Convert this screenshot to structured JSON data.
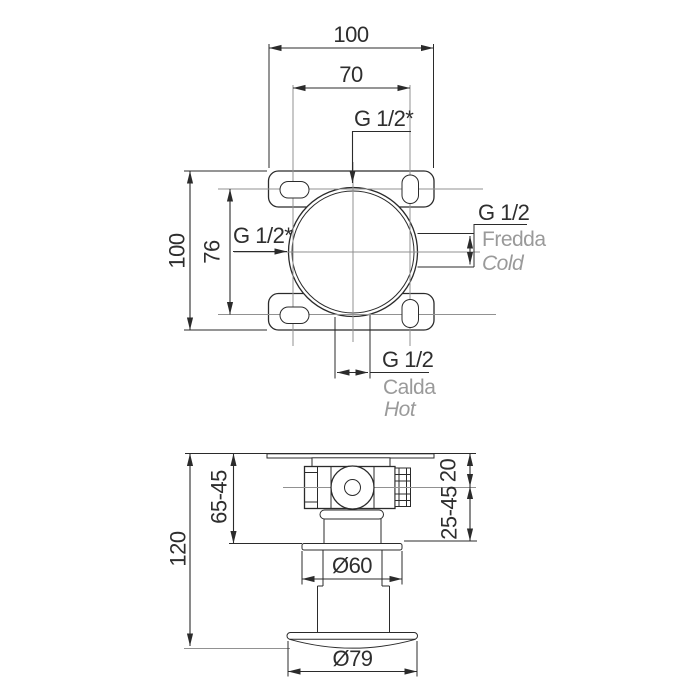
{
  "title": "concealed-shower-mixer-installation-drawing",
  "colors": {
    "background": "#ffffff",
    "line": "#2b2b2b",
    "construction": "#9a9a9a",
    "label_gray": "#9a9a9a"
  },
  "plan": {
    "dim_top_outer": "100",
    "dim_top_inner": "70",
    "thread_top": "G 1/2*",
    "thread_left": "G 1/2*",
    "dim_left_inner": "76",
    "dim_left_outer": "100",
    "cold": {
      "thread": "G 1/2",
      "it": "Fredda",
      "en": "Cold"
    },
    "hot": {
      "thread": "G 1/2",
      "it": "Calda",
      "en": "Hot"
    }
  },
  "section": {
    "dim_total": "120",
    "dim_left_range": "65-45",
    "dim_right_top": "20",
    "dim_right_range": "25-45",
    "dim_flange": "Ø60",
    "dim_escutcheon": "Ø79"
  }
}
